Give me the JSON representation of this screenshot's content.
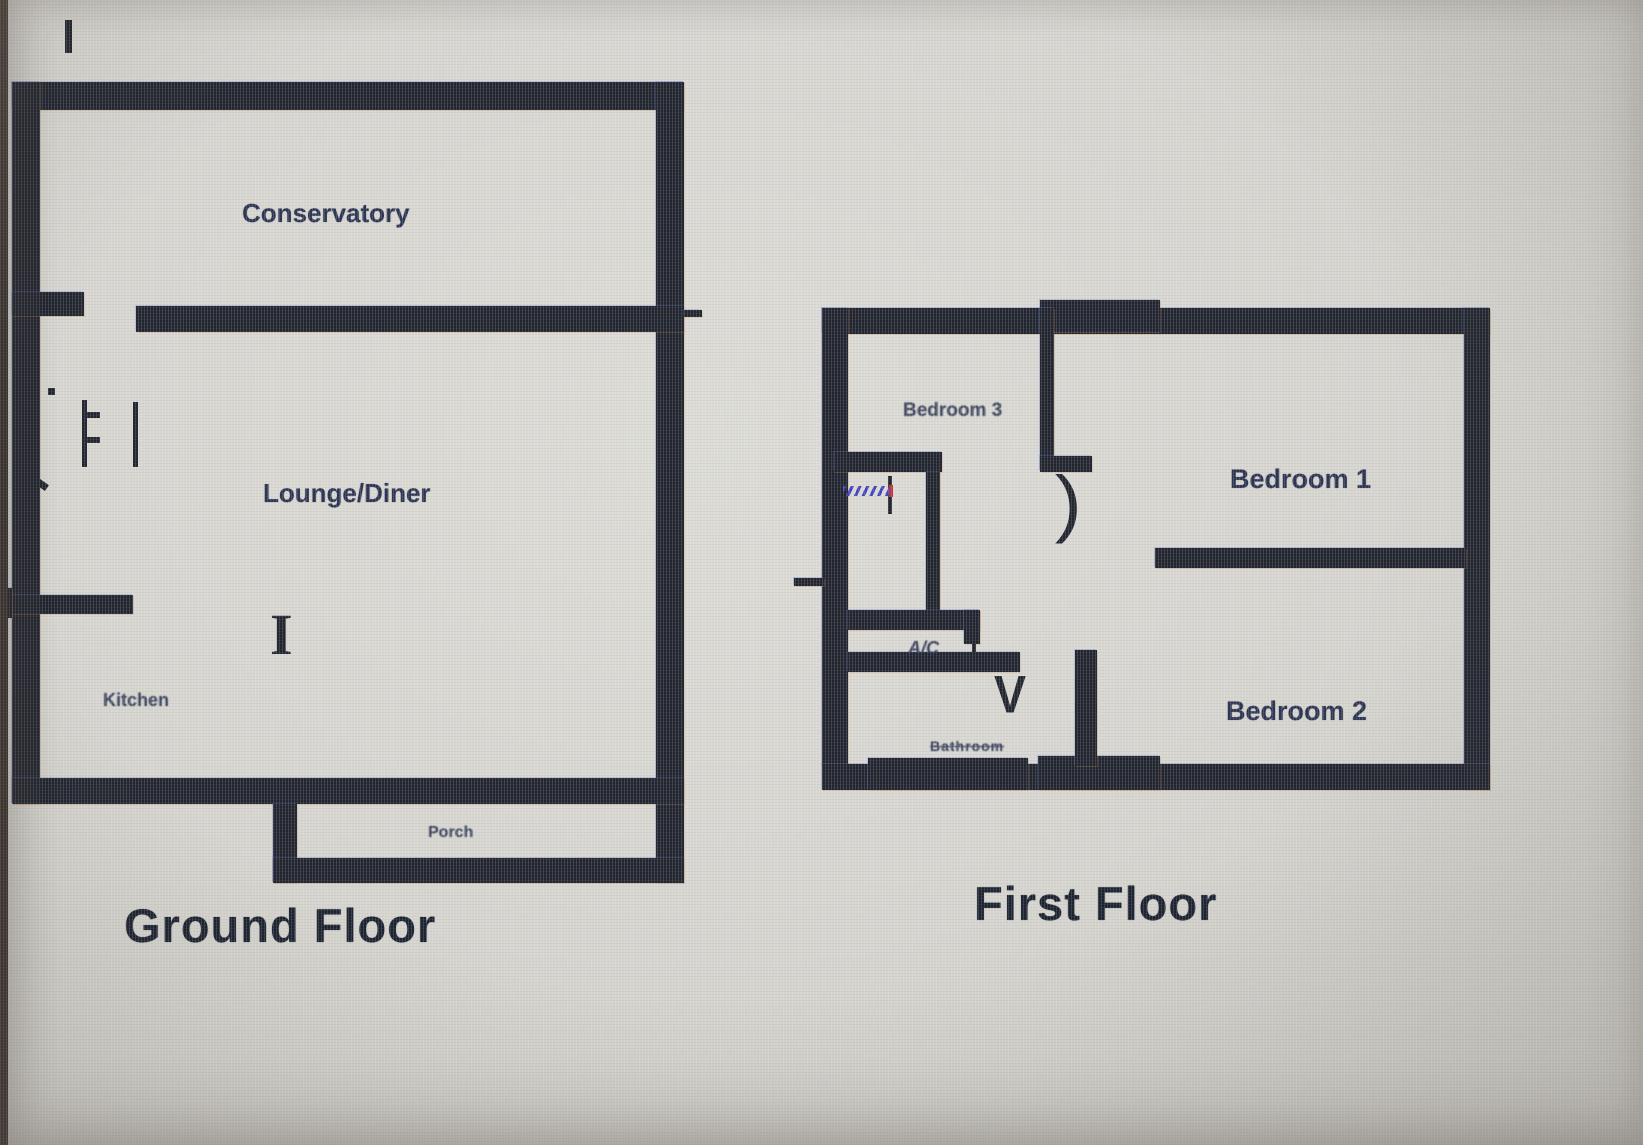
{
  "colors": {
    "wall": "#21252f",
    "room_label": "#2b3452",
    "floor_title": "#1b2230",
    "paper_background": "#d6d5d0",
    "photo_edge": "#332e2b",
    "stairs_annotation": "#4243c0",
    "stairs_annotation_accent": "#b23642"
  },
  "ground_floor": {
    "title": "Ground Floor",
    "rooms": {
      "conservatory": "Conservatory",
      "lounge_diner": "Lounge/Diner",
      "kitchen": "Kitchen",
      "porch": "Porch"
    },
    "door_post_glyph": "I"
  },
  "first_floor": {
    "title": "First Floor",
    "rooms": {
      "bedroom3": "Bedroom 3",
      "bedroom1": "Bedroom 1",
      "bedroom2": "Bedroom 2",
      "airing_cupboard": "A/C",
      "bathroom": "Bathroom"
    },
    "door_swing_glyph": ")",
    "bathroom_door_glyph": "V"
  }
}
